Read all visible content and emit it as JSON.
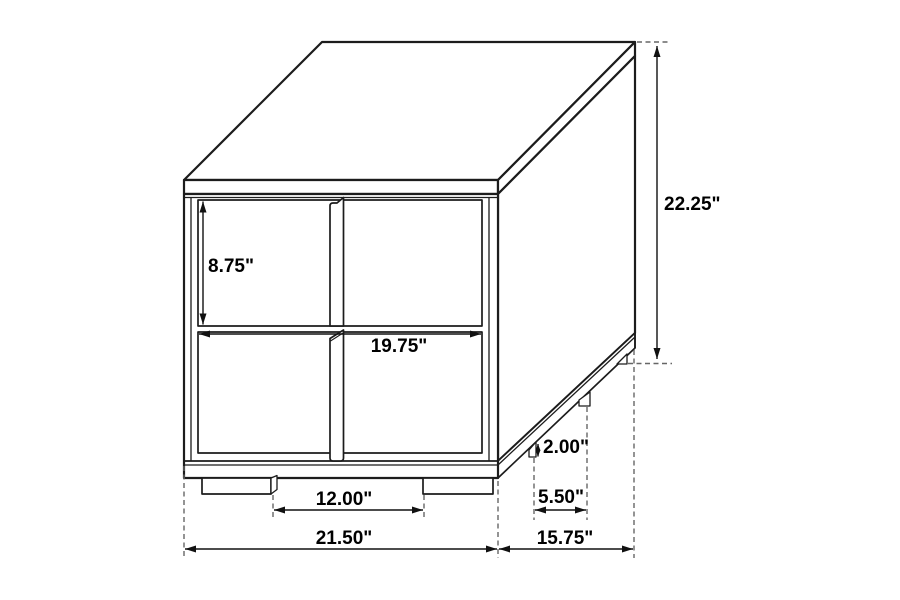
{
  "diagram": {
    "background_color": "#ffffff",
    "line_color": "#1c1c1c",
    "dashed_line_color": "#666666",
    "label_color": "#000000",
    "labels": {
      "overall_height": "22.25\"",
      "drawer_height": "8.75\"",
      "drawer_width": "19.75\"",
      "front_feet_spacing": "12.00\"",
      "overall_width": "21.50\"",
      "overall_depth": "15.75\"",
      "foot_height": "2.00\"",
      "side_feet_spacing": "5.50\""
    }
  }
}
